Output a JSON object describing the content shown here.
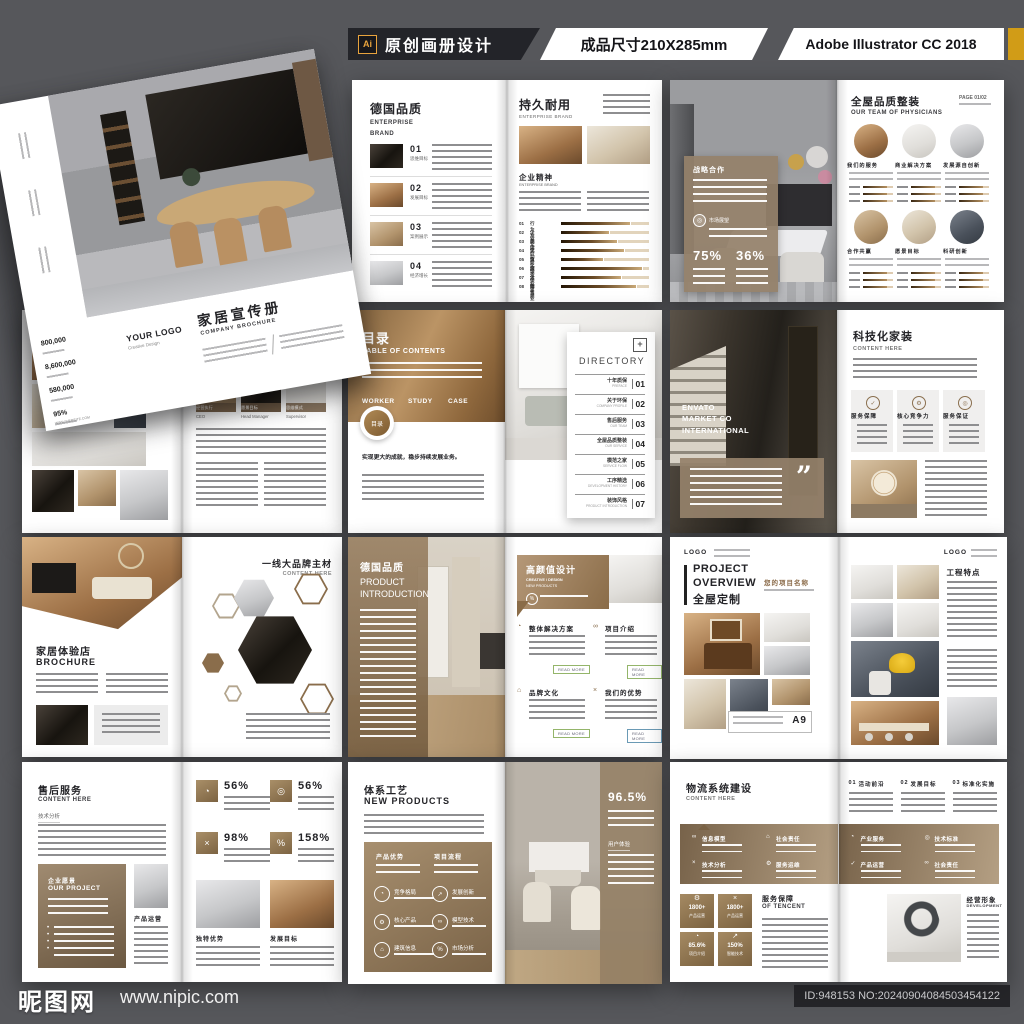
{
  "header": {
    "ai": "Ai",
    "title": "原创画册设计",
    "size": "成品尺寸210X285mm",
    "software": "Adobe Illustrator CC 2018"
  },
  "footer": {
    "site": "昵图网",
    "url": "www.nipic.com",
    "id_no": "ID:948153 NO:20240904084503454122"
  },
  "icons": {
    "plus": "+",
    "target": "◎",
    "check": "✓",
    "gear": "⚙",
    "chart": "◔",
    "link": "∞",
    "home": "⌂",
    "percent": "%",
    "arrow": "↗",
    "close": "×",
    "quote": "”"
  },
  "mockup": {
    "logo": "YOUR LOGO",
    "logo_sub": "Creative Design",
    "title_zh": "家居宣传册",
    "title_en": "COMPANY BROCHURE",
    "site": "WWW.WEBSITE.COM",
    "stats": [
      {
        "v": "800,000"
      },
      {
        "v": "8,600,000"
      },
      {
        "v": "580,000"
      },
      {
        "v": "95%"
      }
    ]
  },
  "quality": {
    "title": "德国品质",
    "sub1": "ENTERPRISE",
    "sub2": "BRAND",
    "items": [
      {
        "no": "01",
        "label": "思维目标"
      },
      {
        "no": "02",
        "label": "发展目标"
      },
      {
        "no": "03",
        "label": "案例展示"
      },
      {
        "no": "04",
        "label": "经济增长"
      }
    ],
    "right_title": "持久耐用",
    "right_sub": "ENTERPRISE BRAND",
    "section": "企业精神",
    "section_sub": "ENTERPRISE BRAND",
    "bars": [
      {
        "no": "01",
        "label": "行为准则",
        "pct": "78%"
      },
      {
        "no": "02",
        "label": "企业文化",
        "pct": "55%"
      },
      {
        "no": "03",
        "label": "品牌价值",
        "pct": "64%"
      },
      {
        "no": "04",
        "label": "活动前沿",
        "pct": "72%"
      },
      {
        "no": "05",
        "label": "文化理念",
        "pct": "48%"
      },
      {
        "no": "06",
        "label": "服务保障",
        "pct": "92%"
      },
      {
        "no": "07",
        "label": "企业思想",
        "pct": "68%"
      },
      {
        "no": "08",
        "label": "销售业绩",
        "pct": "85%"
      }
    ]
  },
  "team": {
    "card_title": "战略合作",
    "card_tag": "市场展望",
    "stat1": "75%",
    "stat2": "36%",
    "title": "全屋品质整装",
    "sub": "OUR TEAM OF PHYSICIANS",
    "page": "PAGE 01/02",
    "circles": [
      "我们的服务",
      "商业解决方案",
      "发展源自创新",
      "合作共赢",
      "愿景目标",
      "科研创新"
    ]
  },
  "collage": {
    "roles": [
      {
        "zh": "经营执行",
        "en": "CEO"
      },
      {
        "zh": "愿景目标",
        "en": "Head Manager"
      },
      {
        "zh": "思维模式",
        "en": "Supervisor"
      }
    ]
  },
  "toc": {
    "title": "目录",
    "sub": "TABLE OF CONTENTS",
    "tags": [
      "WORKER",
      "STUDY",
      "CASE"
    ],
    "badge": "目录",
    "note": "实现更大的成就，稳步持续发展业务。",
    "dir_title": "DIRECTORY",
    "items": [
      {
        "zh": "十年质保",
        "en": "PREFACE",
        "no": "01"
      },
      {
        "zh": "关于环保",
        "en": "COMPANY PROFILE",
        "no": "02"
      },
      {
        "zh": "售后服务",
        "en": "OUR TEAM",
        "no": "03"
      },
      {
        "zh": "全屋品质整装",
        "en": "OUR SERVICE",
        "no": "04"
      },
      {
        "zh": "模范之家",
        "en": "SERVICE FLOW",
        "no": "05"
      },
      {
        "zh": "工序精选",
        "en": "DEVELOPMENT HISTORY",
        "no": "06"
      },
      {
        "zh": "装饰风格",
        "en": "PRODUCT INTRODUCTION",
        "no": "07"
      }
    ]
  },
  "tech": {
    "photo_caption": "ENVATO MARKET CO INTERNATIONAL",
    "title": "科技化家装",
    "sub": "CONTENT HERE",
    "boxes": [
      "服务保障",
      "核心竞争力",
      "服务保证"
    ]
  },
  "brand": {
    "left_title": "家居体验店",
    "left_sub": "BROCHURE",
    "right_title": "一线大品牌主材",
    "right_sub": "CONTENT HERE"
  },
  "product": {
    "left_title": "德国品质",
    "left_sub1": "PRODUCT",
    "left_sub2": "INTRODUCTION",
    "right_title": "高颜值设计",
    "right_sub1": "CREATIVE / DESIGN",
    "right_sub2": "NEW PRODUCTS",
    "sections": [
      "整体解决方案",
      "项目介绍",
      "品牌文化",
      "我们的优势"
    ],
    "read_more": "READ MORE"
  },
  "project": {
    "logo": "LOGO",
    "t1": "PROJECT",
    "t2": "OVERVIEW",
    "t3": "全屋定制",
    "name_label": "您的项目名称",
    "a9": "A9",
    "right_title": "工程特点"
  },
  "aftersale": {
    "title": "售后服务",
    "sub": "CONTENT HERE",
    "analysis": "技术分析",
    "box_zh": "企业愿景",
    "box_en": "OUR PROJECT",
    "photo_label": "产品运营",
    "stats": [
      {
        "v": "56%"
      },
      {
        "v": "56%"
      },
      {
        "v": "98%"
      },
      {
        "v": "158%"
      }
    ],
    "photo_labels": [
      "独特优势",
      "发展目标"
    ]
  },
  "process": {
    "title": "体系工艺",
    "sub": "NEW PRODUCTS",
    "cols": [
      "产品优势",
      "项目流程"
    ],
    "items": [
      "竞争格局",
      "发展创新",
      "核心产品",
      "模型技术",
      "建筑信息",
      "市场分析"
    ],
    "stat": "96.5%",
    "stat_label": "用户体验"
  },
  "logistics": {
    "title": "物流系统建设",
    "sub": "CONTENT HERE",
    "top_items": [
      {
        "no": "01",
        "label": "活动前沿"
      },
      {
        "no": "02",
        "label": "发展目标"
      },
      {
        "no": "03",
        "label": "标准化实施"
      }
    ],
    "band": [
      "信息模型",
      "社会责任",
      "技术分析",
      "服务运维",
      "产业服务",
      "技术标准",
      "产品运营",
      "社会责任"
    ],
    "tiles": [
      {
        "v": "1800+",
        "label": "产品运营"
      },
      {
        "v": "1800+",
        "label": "产品运营"
      },
      {
        "v": "85.6%",
        "label": "项目介绍"
      },
      {
        "v": "150%",
        "label": "智能技术"
      }
    ],
    "service_zh": "服务保障",
    "service_en": "OF TENCENT",
    "right_zh": "经营形象",
    "right_en": "DEVELOPMENT"
  }
}
